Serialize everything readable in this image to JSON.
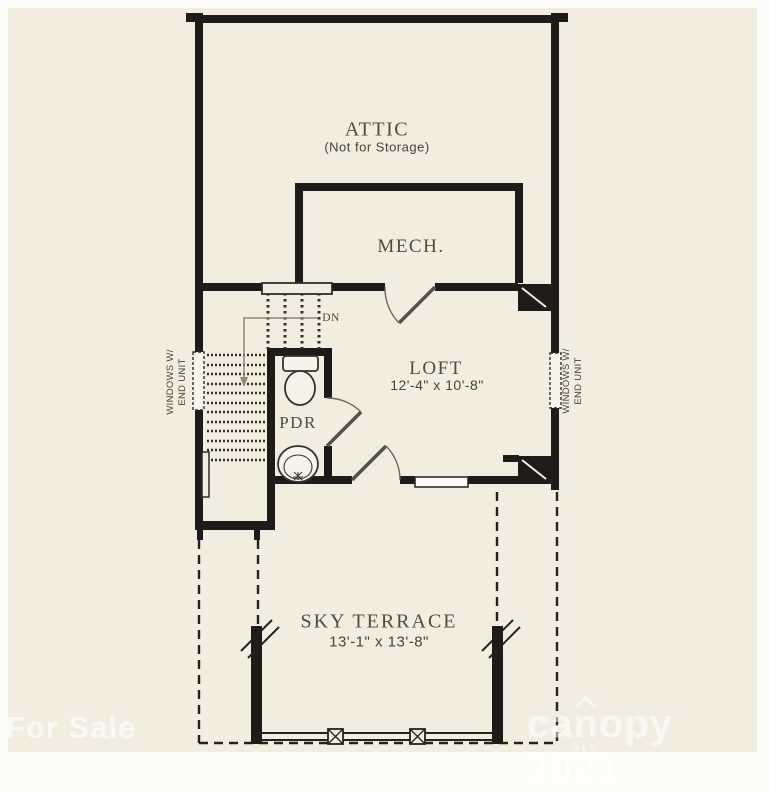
{
  "palette": {
    "paper": "#f1ede1",
    "margin": "#fcfcf9",
    "wall": "#1d1c18",
    "line": "#2e2d29",
    "label_text": "#514b40",
    "watermark": "rgba(255,255,255,0.6)"
  },
  "rooms": {
    "attic": {
      "name": "ATTIC",
      "note": "(Not for Storage)"
    },
    "mech": {
      "name": "MECH."
    },
    "loft": {
      "name": "LOFT",
      "dimensions": "12'-4\" x 10'-8\""
    },
    "pdr": {
      "name": "PDR"
    },
    "terrace": {
      "name": "SKY TERRACE",
      "dimensions": "13'-1\" x 13'-8\""
    }
  },
  "annotations": {
    "stair_direction": "DN",
    "window_note": {
      "line1": "WINDOWS W/",
      "line2": "END UNIT"
    }
  },
  "watermarks": {
    "left": "For Sale",
    "right_brand": "canopy",
    "right_year": "2021",
    "right_sub": "MLS"
  }
}
